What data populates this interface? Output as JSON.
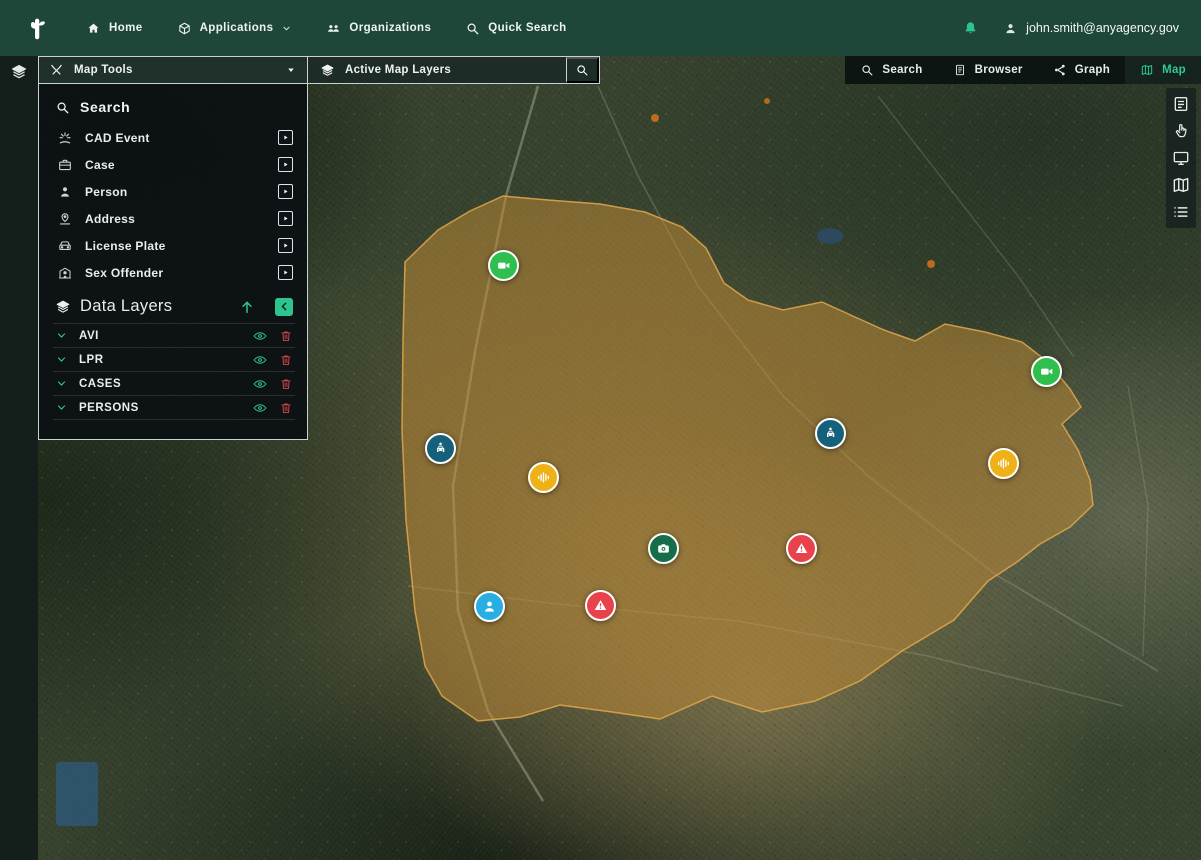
{
  "topnav": {
    "items": [
      {
        "label": "Home",
        "icon": "home-icon"
      },
      {
        "label": "Applications",
        "icon": "applications-icon",
        "caret": true
      },
      {
        "label": "Organizations",
        "icon": "organizations-icon"
      },
      {
        "label": "Quick Search",
        "icon": "search-icon"
      }
    ],
    "user_email": "john.smith@anyagency.gov"
  },
  "toolbar": {
    "map_tools_label": "Map Tools",
    "active_layers_label": "Active Map Layers",
    "view_buttons": [
      {
        "label": "Search",
        "icon": "search-icon",
        "active": false
      },
      {
        "label": "Browser",
        "icon": "document-icon",
        "active": false
      },
      {
        "label": "Graph",
        "icon": "graph-icon",
        "active": false
      },
      {
        "label": "Map",
        "icon": "map-icon",
        "active": true
      }
    ]
  },
  "panel": {
    "search_title": "Search",
    "search_items": [
      {
        "label": "CAD Event",
        "icon": "cad-event-icon"
      },
      {
        "label": "Case",
        "icon": "case-icon"
      },
      {
        "label": "Person",
        "icon": "person-icon"
      },
      {
        "label": "Address",
        "icon": "address-icon"
      },
      {
        "label": "License Plate",
        "icon": "license-plate-icon"
      },
      {
        "label": "Sex Offender",
        "icon": "sex-offender-icon"
      }
    ],
    "data_layers_title": "Data Layers",
    "data_layers": [
      {
        "label": "AVI"
      },
      {
        "label": "LPR"
      },
      {
        "label": "CASES"
      },
      {
        "label": "PERSONS"
      }
    ]
  },
  "right_rail": [
    "notes-icon",
    "pointer-hand-icon",
    "monitor-icon",
    "map-icon",
    "list-icon"
  ],
  "colors": {
    "topbar_green": "#1e4639",
    "accent_green": "#2ec48f",
    "alert_red": "#e2474b",
    "region_fill": "#c08a36",
    "marker_video": "#2ebf4e",
    "marker_avi": "#15607a",
    "marker_audio": "#eeb117",
    "marker_photo": "#156e49",
    "marker_alert": "#e8434d",
    "marker_person": "#29aee3"
  },
  "map": {
    "region_overlay": {
      "fill": "#c08a36",
      "opacity": 0.52,
      "points": [
        [
          405,
          262
        ],
        [
          438,
          230
        ],
        [
          470,
          211
        ],
        [
          503,
          196
        ],
        [
          548,
          200
        ],
        [
          600,
          204
        ],
        [
          645,
          212
        ],
        [
          682,
          227
        ],
        [
          706,
          248
        ],
        [
          724,
          283
        ],
        [
          748,
          300
        ],
        [
          783,
          310
        ],
        [
          822,
          302
        ],
        [
          855,
          317
        ],
        [
          884,
          330
        ],
        [
          915,
          341
        ],
        [
          945,
          324
        ],
        [
          985,
          332
        ],
        [
          1022,
          342
        ],
        [
          1048,
          362
        ],
        [
          1070,
          389
        ],
        [
          1081,
          407
        ],
        [
          1062,
          424
        ],
        [
          1078,
          450
        ],
        [
          1090,
          480
        ],
        [
          1093,
          505
        ],
        [
          1070,
          527
        ],
        [
          1040,
          544
        ],
        [
          1017,
          562
        ],
        [
          988,
          581
        ],
        [
          954,
          620
        ],
        [
          902,
          651
        ],
        [
          860,
          681
        ],
        [
          815,
          701
        ],
        [
          762,
          712
        ],
        [
          712,
          696
        ],
        [
          660,
          719
        ],
        [
          612,
          712
        ],
        [
          560,
          705
        ],
        [
          520,
          717
        ],
        [
          478,
          721
        ],
        [
          442,
          696
        ],
        [
          425,
          666
        ],
        [
          415,
          611
        ],
        [
          406,
          520
        ],
        [
          402,
          430
        ],
        [
          403,
          340
        ]
      ]
    },
    "markers": [
      {
        "type": "video-camera",
        "x": 503,
        "y": 265
      },
      {
        "type": "video-camera",
        "x": 1046,
        "y": 371
      },
      {
        "type": "avi-vehicle",
        "x": 440,
        "y": 448
      },
      {
        "type": "avi-vehicle",
        "x": 830,
        "y": 433
      },
      {
        "type": "audio-sensor",
        "x": 543,
        "y": 477
      },
      {
        "type": "audio-sensor",
        "x": 1003,
        "y": 463
      },
      {
        "type": "photo-camera",
        "x": 663,
        "y": 548
      },
      {
        "type": "alert",
        "x": 801,
        "y": 548
      },
      {
        "type": "alert",
        "x": 600,
        "y": 605
      },
      {
        "type": "person",
        "x": 489,
        "y": 606
      }
    ]
  }
}
